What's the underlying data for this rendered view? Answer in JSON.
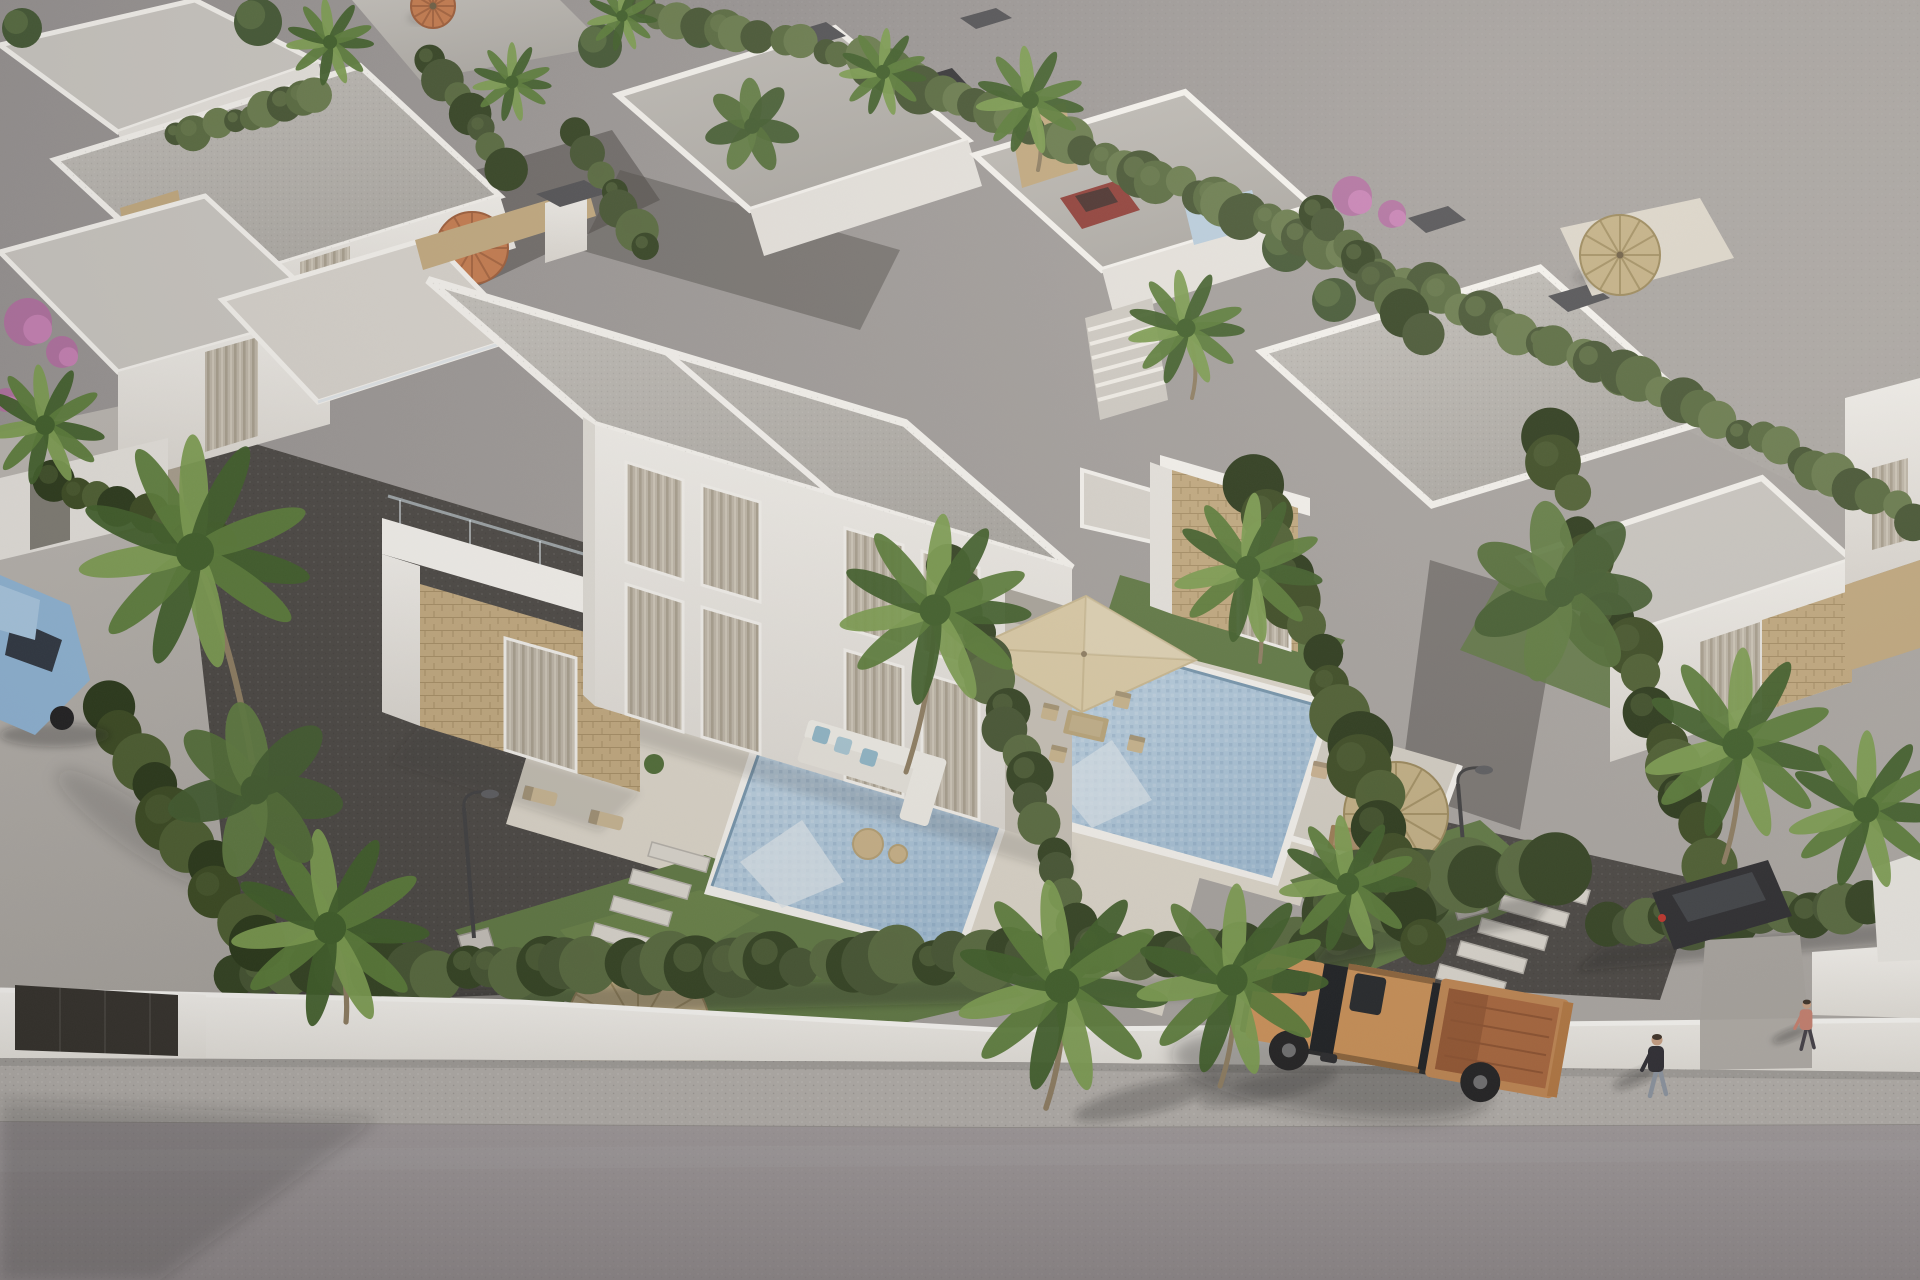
{
  "meta": {
    "title": "Aerial 3D render of a residential development of modern white flat-roof villas with private pools, gardens, palm trees, a perimeter wall and a street with an orange pickup truck",
    "setting": "late-afternoon sun from upper right, long soft shadows to lower left"
  },
  "palette": {
    "land": "#9d9995",
    "land_light": "#aca8a4",
    "street": "#b6b2ad",
    "road": "#9a9496",
    "sidewalk": "#b3afab",
    "wall_white": "#f1efeb",
    "wall_shade": "#e3e0da",
    "gate_dark": "#33302b",
    "roof_gravel": "#b5b2ad",
    "roof_light": "#cac7c2",
    "parapet": "#f6f4f0",
    "facade": "#f3f1ed",
    "facade_shade": "#e7e4df",
    "facade_dark": "#d8d5cf",
    "stone": "#c2a97e",
    "stone_dark": "#a98e60",
    "window": "#6b6860",
    "curtain": "#beb6a8",
    "glass_dark": "#3a3e42",
    "gravel_dark": "#474441",
    "gravel_fleck": "#5c5955",
    "lawn": "#5d7741",
    "lawn_light": "#6f8a4a",
    "hedge": "#42522f",
    "hedge_light": "#55683c",
    "hedge_dark": "#30401f",
    "pool_deep": "#9fbdd6",
    "pool_light": "#c9dbe8",
    "pool_step": "#dde7ee",
    "pool_edge": "#7495ae",
    "deck": "#ddd7cb",
    "terrace": "#d4cfc5",
    "palm": "#577a36",
    "palm_light": "#7a9c4e",
    "palm_dark": "#3c5c26",
    "trunk": "#8d7c60",
    "straw": "#c3b084",
    "straw_rib": "#9a8759",
    "orange_parasol": "#c5794b",
    "beige_parasol": "#dbcba6",
    "truck_body": "#c98e57",
    "truck_bed": "#a8643a",
    "truck_glass": "#16191d",
    "tire": "#1d1d1f",
    "car_blue": "#8fb6d8",
    "skin": "#c9a083",
    "shirt_dark": "#2a2930",
    "jeans": "#8b94a1",
    "chimney_cap": "#4e4e52",
    "shadow": "rgba(40,38,36,0.30)"
  },
  "scene": {
    "hedges": [
      {
        "x1": 235,
        "y1": 975,
        "x2": 1345,
        "y2": 948,
        "r": 26,
        "n": 44,
        "tone": 0,
        "sh": true
      },
      {
        "x1": 1338,
        "y1": 905,
        "x2": 1560,
        "y2": 862,
        "r": 34,
        "n": 10,
        "tone": 0,
        "sh": true
      },
      {
        "x1": 1602,
        "y1": 928,
        "x2": 1916,
        "y2": 900,
        "r": 24,
        "n": 15,
        "tone": 0,
        "sh": true
      },
      {
        "x1": 100,
        "y1": 705,
        "x2": 258,
        "y2": 948,
        "r": 28,
        "n": 10,
        "tone": 2,
        "sh": false
      },
      {
        "x1": 952,
        "y1": 566,
        "x2": 1088,
        "y2": 944,
        "r": 21,
        "n": 17,
        "tone": 0,
        "sh": false
      },
      {
        "x1": 1254,
        "y1": 488,
        "x2": 1428,
        "y2": 936,
        "r": 26,
        "n": 17,
        "tone": 2,
        "sh": false
      },
      {
        "x1": 1548,
        "y1": 438,
        "x2": 1704,
        "y2": 860,
        "r": 24,
        "n": 15,
        "tone": 2,
        "sh": false
      },
      {
        "x1": 872,
        "y1": 66,
        "x2": 1246,
        "y2": 214,
        "r": 19,
        "n": 22,
        "tone": 1,
        "sh": false
      },
      {
        "x1": 1246,
        "y1": 214,
        "x2": 1618,
        "y2": 372,
        "r": 19,
        "n": 20,
        "tone": 1,
        "sh": false
      },
      {
        "x1": 1618,
        "y1": 372,
        "x2": 1916,
        "y2": 518,
        "r": 19,
        "n": 16,
        "tone": 1,
        "sh": false
      },
      {
        "x1": 430,
        "y1": 58,
        "x2": 506,
        "y2": 166,
        "r": 17,
        "n": 7,
        "tone": 0,
        "sh": false
      },
      {
        "x1": 576,
        "y1": 132,
        "x2": 646,
        "y2": 250,
        "r": 17,
        "n": 7,
        "tone": 0,
        "sh": false
      },
      {
        "x1": 1312,
        "y1": 210,
        "x2": 1424,
        "y2": 330,
        "r": 19,
        "n": 8,
        "tone": 0,
        "sh": false
      },
      {
        "x1": 60,
        "y1": 480,
        "x2": 208,
        "y2": 545,
        "r": 18,
        "n": 8,
        "tone": 2,
        "sh": false
      },
      {
        "x1": 640,
        "y1": 10,
        "x2": 862,
        "y2": 58,
        "r": 16,
        "n": 12,
        "tone": 1,
        "sh": false
      },
      {
        "x1": 178,
        "y1": 136,
        "x2": 318,
        "y2": 96,
        "r": 15,
        "n": 9,
        "tone": 1,
        "sh": false
      }
    ],
    "palms": [
      {
        "x": 195,
        "y": 552,
        "r": 112,
        "tr": [
          252,
          762
        ]
      },
      {
        "x": 330,
        "y": 928,
        "r": 95,
        "tr": [
          346,
          1022
        ]
      },
      {
        "x": 45,
        "y": 425,
        "r": 58
      },
      {
        "x": 935,
        "y": 610,
        "r": 92,
        "tr": [
          906,
          772
        ]
      },
      {
        "x": 1248,
        "y": 568,
        "r": 72,
        "tr": [
          1260,
          662
        ]
      },
      {
        "x": 1062,
        "y": 986,
        "r": 102,
        "tr": [
          1046,
          1108
        ]
      },
      {
        "x": 1232,
        "y": 980,
        "r": 92,
        "tr": [
          1220,
          1086
        ]
      },
      {
        "x": 1348,
        "y": 884,
        "r": 66
      },
      {
        "x": 1738,
        "y": 744,
        "r": 92,
        "tr": [
          1724,
          862
        ]
      },
      {
        "x": 1866,
        "y": 810,
        "r": 76
      },
      {
        "x": 1030,
        "y": 100,
        "r": 52,
        "tr": [
          1038,
          170
        ]
      },
      {
        "x": 883,
        "y": 72,
        "r": 42
      },
      {
        "x": 330,
        "y": 42,
        "r": 42
      },
      {
        "x": 512,
        "y": 82,
        "r": 38
      },
      {
        "x": 1186,
        "y": 328,
        "r": 56,
        "tr": [
          1192,
          398
        ]
      },
      {
        "x": 622,
        "y": 16,
        "r": 34
      }
    ],
    "bananas": [
      {
        "x": 255,
        "y": 790,
        "r": 85
      },
      {
        "x": 1560,
        "y": 592,
        "r": 88
      },
      {
        "x": 752,
        "y": 126,
        "r": 46
      }
    ],
    "trees": [
      {
        "x": 22,
        "y": 28,
        "r": 20
      },
      {
        "x": 258,
        "y": 22,
        "r": 24
      },
      {
        "x": 600,
        "y": 46,
        "r": 22
      },
      {
        "x": 1286,
        "y": 248,
        "r": 24
      },
      {
        "x": 1334,
        "y": 300,
        "r": 22
      },
      {
        "x": 700,
        "y": 30,
        "r": 18
      }
    ],
    "flowers": [
      {
        "x": 28,
        "y": 322,
        "r": 24
      },
      {
        "x": 62,
        "y": 352,
        "r": 16
      },
      {
        "x": 1352,
        "y": 196,
        "r": 20
      },
      {
        "x": 1392,
        "y": 214,
        "r": 14
      },
      {
        "x": 6,
        "y": 400,
        "r": 12
      }
    ],
    "parasols": [
      {
        "type": "orange",
        "x": 472,
        "y": 248,
        "r": 36
      },
      {
        "type": "orange",
        "x": 433,
        "y": 6,
        "r": 22
      },
      {
        "type": "straw",
        "x": 1620,
        "y": 255,
        "r": 40
      },
      {
        "type": "straw",
        "x": 1396,
        "y": 814,
        "r": 52
      },
      {
        "type": "straw",
        "x": 638,
        "y": 1030,
        "r": 72
      }
    ],
    "square_parasol": {
      "points": [
        [
          1086,
          596
        ],
        [
          1196,
          660
        ],
        [
          1082,
          712
        ],
        [
          972,
          648
        ]
      ],
      "center": [
        1084,
        654
      ]
    },
    "steps": [
      {
        "x": 652,
        "y": 842,
        "w": 58,
        "h": 14,
        "dx": -19,
        "dy": 27,
        "n": 5
      },
      {
        "x": 588,
        "y": 972,
        "w": 60,
        "h": 14,
        "dx": -23,
        "dy": 30,
        "n": 5
      },
      {
        "x": 1524,
        "y": 872,
        "w": 66,
        "h": 14,
        "dx": -21,
        "dy": 23,
        "n": 5
      }
    ],
    "lamps": [
      {
        "x": 474,
        "y": 942,
        "top": 790
      },
      {
        "x": 1468,
        "y": 906,
        "top": 766
      }
    ],
    "furniture": [
      {
        "t": "lounger",
        "x": 540,
        "y": 796,
        "rot": 14,
        "c": "#c8b592"
      },
      {
        "t": "lounger",
        "x": 606,
        "y": 820,
        "rot": 14,
        "c": "#c8b592"
      },
      {
        "t": "lounger",
        "x": 686,
        "y": 1082,
        "rot": 14,
        "c": "#6f5f48"
      },
      {
        "t": "lounger",
        "x": 760,
        "y": 1106,
        "rot": 14,
        "c": "#6f5f48"
      },
      {
        "t": "chair",
        "x": 1320,
        "y": 770,
        "rot": 12,
        "c": "#cbb391"
      },
      {
        "t": "chair",
        "x": 1382,
        "y": 796,
        "rot": 12,
        "c": "#cbb391"
      },
      {
        "t": "table",
        "x": 1350,
        "y": 840,
        "rot": 10,
        "c": "#9b7b52"
      }
    ],
    "dining_set": [
      {
        "t": "table",
        "x": 1086,
        "y": 726,
        "rot": 13,
        "c": "#b9a478"
      },
      {
        "t": "chair",
        "x": 1050,
        "y": 712,
        "rot": 13,
        "c": "#c8b48c"
      },
      {
        "t": "chair",
        "x": 1122,
        "y": 700,
        "rot": 13,
        "c": "#c8b48c"
      },
      {
        "t": "chair",
        "x": 1136,
        "y": 744,
        "rot": 13,
        "c": "#c8b48c"
      },
      {
        "t": "chair",
        "x": 1058,
        "y": 754,
        "rot": 13,
        "c": "#c8b48c"
      }
    ],
    "people": [
      {
        "x": 1656,
        "y": 1072,
        "shirt": "#2a2930",
        "pants": "#8b94a1",
        "s": 1
      },
      {
        "x": 1806,
        "y": 1030,
        "shirt": "#c77f6e",
        "pants": "#3f3c44",
        "s": 0.8
      }
    ],
    "vehicles": {
      "pickup_truck": {
        "color": "#c98e57",
        "bed_interior": "#a8643a",
        "position": "street bottom right, driving left"
      },
      "blue_sedan": {
        "color": "#8fb6d8",
        "position": "parked at left edge"
      },
      "parked_background": [
        {
          "color": "#303033"
        },
        {
          "color": "#8e3a34"
        },
        {
          "color": "#28282c"
        }
      ]
    }
  }
}
